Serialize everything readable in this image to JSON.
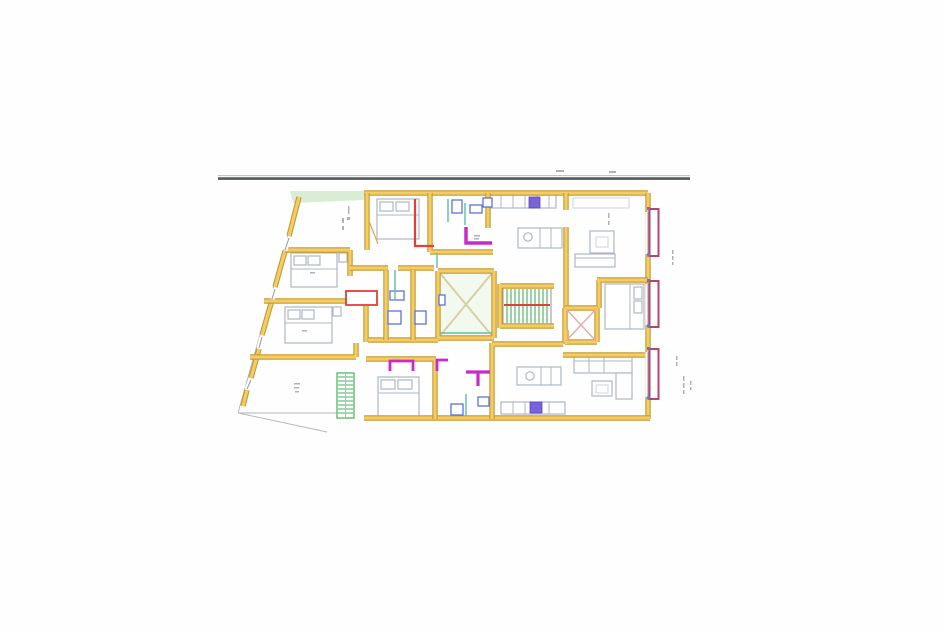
{
  "labels": {
    "title": "Residential apartment floor plan",
    "site_line": "Site boundary line",
    "parcel": "Parcel boundary",
    "building": "Apartment level walls",
    "lightwell": "Lightwell courtyard",
    "main_stair": "Main staircase",
    "service_stair": "Service stair",
    "shaft": "Ventilation shaft",
    "balconies": "Street facade balconies",
    "bedrooms": "Bedroom furniture",
    "living": "Living room furniture",
    "kitchens": "Kitchen units",
    "bathrooms": "Bathroom fixtures",
    "annotations": "Dimension annotations"
  },
  "palette": {
    "paper": "#fefefe",
    "rule_dark": "#54585d",
    "rule_light": "#b9bcc0",
    "gray_line": "#9aa0a6",
    "wall_edge": "#c59a2f",
    "wall_fill": "#f3cc66",
    "furn": "#aeb7c3",
    "furn_light": "#ccd3db",
    "blue": "#5b74d6",
    "violet": "#7a63d8",
    "magenta": "#c92bc9",
    "red": "#e04038",
    "crimson": "#b5446e",
    "teal": "#5fbcaf",
    "green": "#46b054",
    "light_green_fill": "#f2faf0",
    "strip_green": "#d9ecd4",
    "cross_tan": "#d8cfa3",
    "shaft_pink": "#e8aaaa",
    "door_orange": "#e8a14e"
  }
}
